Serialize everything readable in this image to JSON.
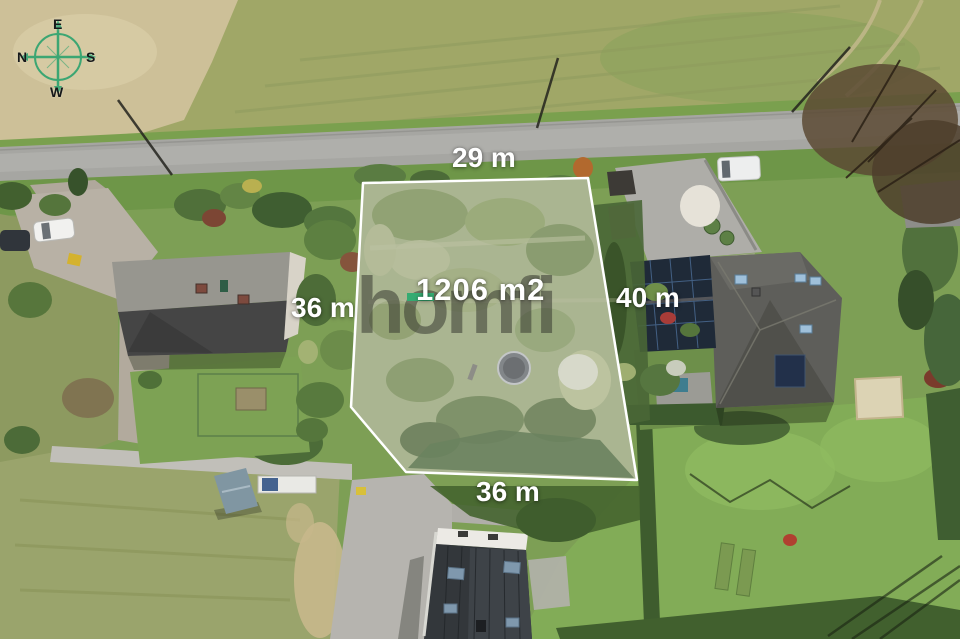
{
  "compass": {
    "icon": "compass-rose",
    "top": "E",
    "right": "S",
    "bottom": "W",
    "left": "N"
  },
  "plot": {
    "area_label": "1206 m2",
    "dimensions": {
      "top": "29 m",
      "left": "36 m",
      "right": "40 m",
      "bottom": "36 m"
    },
    "outline_color": "#ffffff"
  },
  "watermark": {
    "brand": "homfi",
    "accent_color": "#35ab72"
  },
  "colors": {
    "compass_green": "#2fa46f",
    "label_white": "#ffffff"
  }
}
